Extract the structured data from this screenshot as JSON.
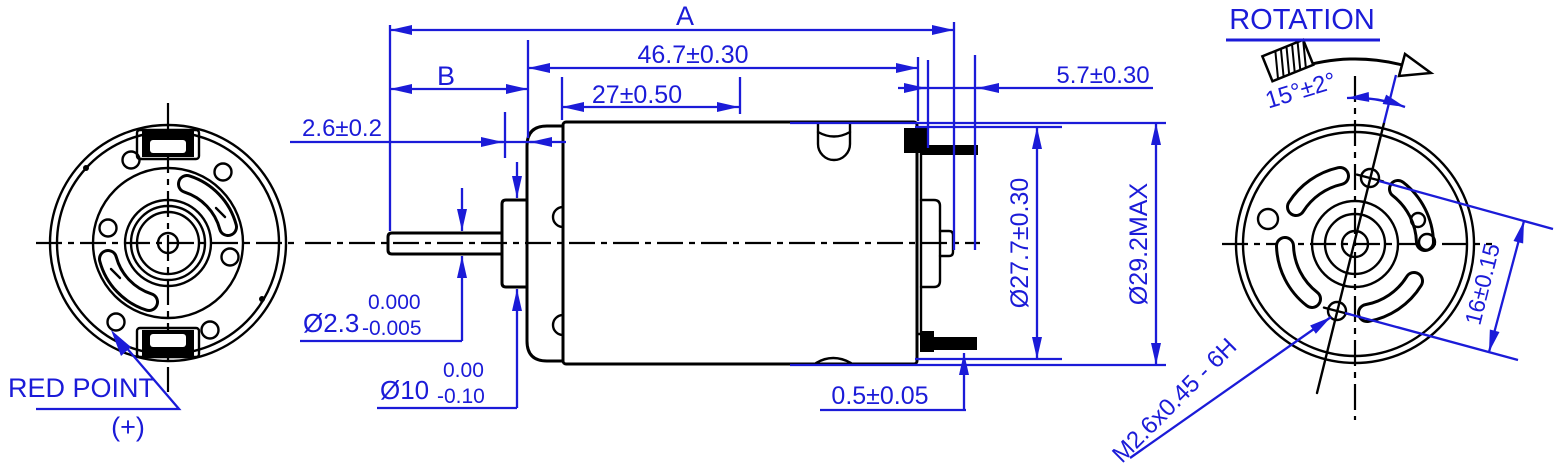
{
  "colors": {
    "dimension_blue": "#1b1bd8",
    "line_black": "#000000",
    "background": "#ffffff"
  },
  "views": {
    "rear_view": {
      "red_point_label": "RED POINT",
      "polarity_label": "(+)"
    },
    "side_view": {
      "dim_overall_length": "A",
      "dim_shaft_length": "B",
      "dim_case_length": "46.7±0.30",
      "dim_stack_length": "27±0.50",
      "dim_terminal_length": "5.7±0.30",
      "dim_bushing_protrusion": "2.6±0.2",
      "shaft_diameter": "Ø2.3",
      "shaft_tol_upper": "0.000",
      "shaft_tol_lower": "-0.005",
      "bushing_diameter": "Ø10",
      "bushing_tol_upper": "0.00",
      "bushing_tol_lower": "-0.10",
      "case_diameter": "Ø27.7±0.30",
      "max_diameter": "Ø29.2MAX",
      "terminal_offset": "0.5±0.05"
    },
    "front_view": {
      "rotation_title": "ROTATION",
      "hole_angle": "15°±2°",
      "thread_spec": "M2.6x0.45 - 6H",
      "hole_pitch": "16±0.15"
    }
  }
}
